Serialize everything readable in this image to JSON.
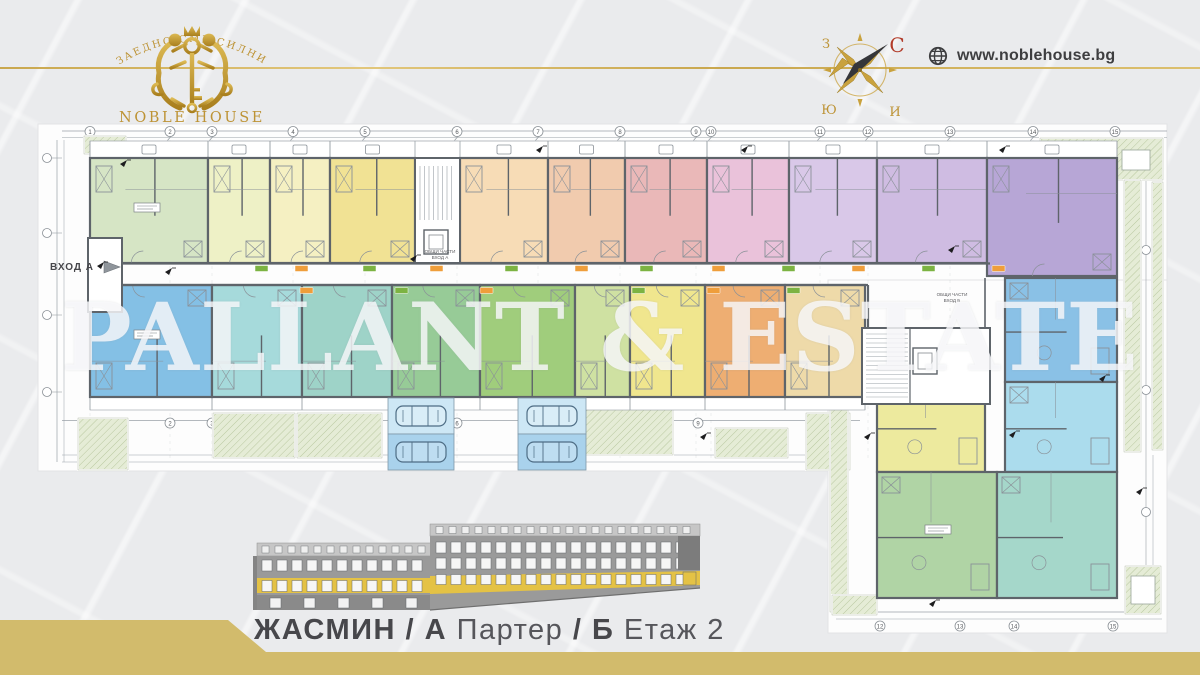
{
  "header": {
    "motto": "ЗАЕДНО СМЕ СИЛНИ",
    "brand": "NOBLE HOUSE",
    "website": "www.noblehouse.bg",
    "compass": {
      "north": "С",
      "west": "З",
      "south": "Ю",
      "east": "И"
    },
    "colors": {
      "gold": "#c2993a",
      "brand_gold": "#bd9335",
      "text_dark": "#3e3e40",
      "compass_north": "#b23c2a",
      "needle": "#35363a"
    }
  },
  "watermark": {
    "text": "PALLANT & ESTATE"
  },
  "caption": {
    "segments": [
      {
        "text": "ЖАСМИН",
        "weight": "bold"
      },
      {
        "text": " / ",
        "weight": "bold"
      },
      {
        "text": "А",
        "weight": "bold"
      },
      {
        "text": " Партер",
        "weight": "light"
      },
      {
        "text": " / ",
        "weight": "bold"
      },
      {
        "text": "Б",
        "weight": "bold"
      },
      {
        "text": " Етаж 2",
        "weight": "light"
      }
    ]
  },
  "footer": {
    "gold": "#d2bb6c",
    "ribbon_points": "0,620 228,620 266,652 1200,652 1200,675 0,675"
  },
  "plan": {
    "labels": {
      "entrance_a": "ВХОД А",
      "common_a_line1": "ОБЩИ ЧАСТИ",
      "common_a_line2": "ВХОД А",
      "common_b_line1": "ОБЩИ ЧАСТИ",
      "common_b_line2": "ВХОД Б"
    },
    "colors": {
      "paper": "#fdfdfd",
      "wall": "#5e646a",
      "line": "#9aa1a7",
      "detail": "#8a9198",
      "landscape_fill": "#e5ecd6",
      "landscape_line": "#b9c8a0",
      "parking_light": "#cde7f5",
      "parking_dark": "#a9d2ec",
      "car_line": "#4e6d85",
      "badge_green": "#7cb342",
      "badge_orange": "#ef9e3b",
      "bubble_text": "#55585c"
    },
    "grid_top": [
      {
        "n": "1",
        "x": 90
      },
      {
        "n": "2",
        "x": 170
      },
      {
        "n": "3",
        "x": 212
      },
      {
        "n": "4",
        "x": 293
      },
      {
        "n": "5",
        "x": 365
      },
      {
        "n": "6",
        "x": 457
      },
      {
        "n": "7",
        "x": 538
      },
      {
        "n": "8",
        "x": 620
      },
      {
        "n": "9",
        "x": 696
      },
      {
        "n": "10",
        "x": 711
      },
      {
        "n": "11",
        "x": 820
      },
      {
        "n": "12",
        "x": 868
      },
      {
        "n": "13",
        "x": 950
      },
      {
        "n": "14",
        "x": 1033
      },
      {
        "n": "15",
        "x": 1115
      }
    ],
    "grid_bottom": [
      {
        "n": "2",
        "x": 170
      },
      {
        "n": "3",
        "x": 212
      },
      {
        "n": "4",
        "x": 293
      },
      {
        "n": "5",
        "x": 365
      },
      {
        "n": "6",
        "x": 457
      },
      {
        "n": "9",
        "x": 698
      }
    ],
    "grid_wing_bottom": [
      {
        "n": "12",
        "x": 880
      },
      {
        "n": "13",
        "x": 960
      },
      {
        "n": "14",
        "x": 1014
      },
      {
        "n": "15",
        "x": 1113
      }
    ],
    "left_bubbles_y": [
      158,
      233,
      315,
      392
    ],
    "right_bubbles_y": [
      250,
      390,
      512,
      590
    ],
    "units": [
      {
        "id": "a1",
        "x": 90,
        "y": 158,
        "w": 118,
        "h": 105,
        "c": "#d6e5c5",
        "row": "top"
      },
      {
        "id": "a2",
        "x": 208,
        "y": 158,
        "w": 62,
        "h": 105,
        "c": "#eef1c6",
        "row": "top"
      },
      {
        "id": "a3",
        "x": 270,
        "y": 158,
        "w": 60,
        "h": 105,
        "c": "#f5f0c2",
        "row": "top"
      },
      {
        "id": "a4",
        "x": 330,
        "y": 158,
        "w": 85,
        "h": 105,
        "c": "#f1e294",
        "row": "top"
      },
      {
        "id": "a5",
        "x": 460,
        "y": 158,
        "w": 88,
        "h": 105,
        "c": "#f7dcb6",
        "row": "top"
      },
      {
        "id": "a6",
        "x": 548,
        "y": 158,
        "w": 77,
        "h": 105,
        "c": "#f1cbae",
        "row": "top"
      },
      {
        "id": "a7",
        "x": 625,
        "y": 158,
        "w": 82,
        "h": 105,
        "c": "#eab8b8",
        "row": "top"
      },
      {
        "id": "a8",
        "x": 707,
        "y": 158,
        "w": 82,
        "h": 105,
        "c": "#eac2da",
        "row": "top"
      },
      {
        "id": "a9",
        "x": 789,
        "y": 158,
        "w": 88,
        "h": 105,
        "c": "#d9c8e8",
        "row": "top"
      },
      {
        "id": "a10",
        "x": 877,
        "y": 158,
        "w": 110,
        "h": 105,
        "c": "#cfbce2",
        "row": "top"
      },
      {
        "id": "a11",
        "x": 987,
        "y": 158,
        "w": 130,
        "h": 118,
        "c": "#b7a6d6",
        "row": "top"
      },
      {
        "id": "b1",
        "x": 90,
        "y": 285,
        "w": 122,
        "h": 112,
        "c": "#84c0e5",
        "row": "bottom"
      },
      {
        "id": "b2",
        "x": 212,
        "y": 285,
        "w": 90,
        "h": 112,
        "c": "#a6dadb",
        "row": "bottom"
      },
      {
        "id": "b3",
        "x": 302,
        "y": 285,
        "w": 90,
        "h": 112,
        "c": "#9ed3c8",
        "row": "bottom"
      },
      {
        "id": "b4",
        "x": 392,
        "y": 285,
        "w": 88,
        "h": 112,
        "c": "#97cb97",
        "row": "bottom"
      },
      {
        "id": "b5",
        "x": 480,
        "y": 285,
        "w": 95,
        "h": 112,
        "c": "#a0cd7c",
        "row": "bottom"
      },
      {
        "id": "b6",
        "x": 575,
        "y": 285,
        "w": 55,
        "h": 112,
        "c": "#cfe1a2",
        "row": "bottom"
      },
      {
        "id": "b7",
        "x": 630,
        "y": 285,
        "w": 75,
        "h": 112,
        "c": "#f0e68e",
        "row": "bottom"
      },
      {
        "id": "b8",
        "x": 705,
        "y": 285,
        "w": 80,
        "h": 112,
        "c": "#eeae72",
        "row": "bottom"
      },
      {
        "id": "b9",
        "x": 785,
        "y": 285,
        "w": 80,
        "h": 112,
        "c": "#eedaa9",
        "row": "bottom"
      },
      {
        "id": "w1",
        "x": 1005,
        "y": 278,
        "w": 112,
        "h": 104,
        "c": "#8ac1e6",
        "row": "wing"
      },
      {
        "id": "w2",
        "x": 1005,
        "y": 382,
        "w": 112,
        "h": 90,
        "c": "#abdced",
        "row": "wing"
      },
      {
        "id": "w3",
        "x": 877,
        "y": 382,
        "w": 108,
        "h": 90,
        "c": "#edea9e",
        "row": "wing"
      },
      {
        "id": "w4",
        "x": 877,
        "y": 472,
        "w": 120,
        "h": 126,
        "c": "#b0d4a5",
        "row": "wing"
      },
      {
        "id": "w5",
        "x": 997,
        "y": 472,
        "w": 120,
        "h": 126,
        "c": "#a5d7ca",
        "row": "wing"
      }
    ],
    "stairwells": [
      {
        "x": 415,
        "y": 158,
        "w": 45,
        "h": 105,
        "dir": "v",
        "elev": [
          424,
          230,
          24,
          24
        ]
      },
      {
        "x": 862,
        "y": 328,
        "w": 128,
        "h": 76,
        "dir": "h",
        "elev": [
          913,
          348,
          24,
          26
        ]
      }
    ],
    "landscape": [
      [
        1040,
        138,
        123,
        42
      ],
      [
        1124,
        180,
        17,
        272
      ],
      [
        1152,
        182,
        11,
        268
      ],
      [
        1125,
        566,
        36,
        48
      ],
      [
        78,
        418,
        50,
        52
      ],
      [
        84,
        136,
        42,
        18
      ],
      [
        213,
        413,
        82,
        45
      ],
      [
        297,
        413,
        85,
        45
      ],
      [
        585,
        400,
        88,
        55
      ],
      [
        715,
        428,
        73,
        30
      ],
      [
        806,
        413,
        44,
        57
      ],
      [
        830,
        380,
        18,
        232
      ],
      [
        832,
        595,
        45,
        20
      ]
    ],
    "planters": [
      [
        1122,
        150,
        28,
        20
      ],
      [
        1131,
        576,
        24,
        28
      ]
    ],
    "parking": [
      {
        "x": 388,
        "y": 398,
        "w": 66,
        "h": 72
      },
      {
        "x": 518,
        "y": 398,
        "w": 68,
        "h": 72
      }
    ],
    "badges_top_x": [
      255,
      295,
      363,
      430,
      505,
      575,
      640,
      712,
      782,
      852,
      922,
      992
    ],
    "badges_bottom_x": [
      300,
      395,
      480,
      632,
      707,
      787
    ],
    "markers": [
      [
        165,
        268
      ],
      [
        410,
        255
      ],
      [
        536,
        146
      ],
      [
        741,
        146
      ],
      [
        999,
        146
      ],
      [
        948,
        246
      ],
      [
        864,
        433
      ],
      [
        700,
        433
      ],
      [
        1099,
        375
      ],
      [
        1136,
        488
      ],
      [
        929,
        600
      ],
      [
        97,
        262
      ],
      [
        120,
        160
      ],
      [
        1009,
        431
      ]
    ]
  },
  "elevation": {
    "roof": "#c6c6c6",
    "body": "#9a9a9a",
    "ground": "#8a8a8a",
    "end_block": "#7c7c7c",
    "window": "#f6f6f6",
    "frame": "#63666a",
    "accent_floor": "#e4c245"
  }
}
